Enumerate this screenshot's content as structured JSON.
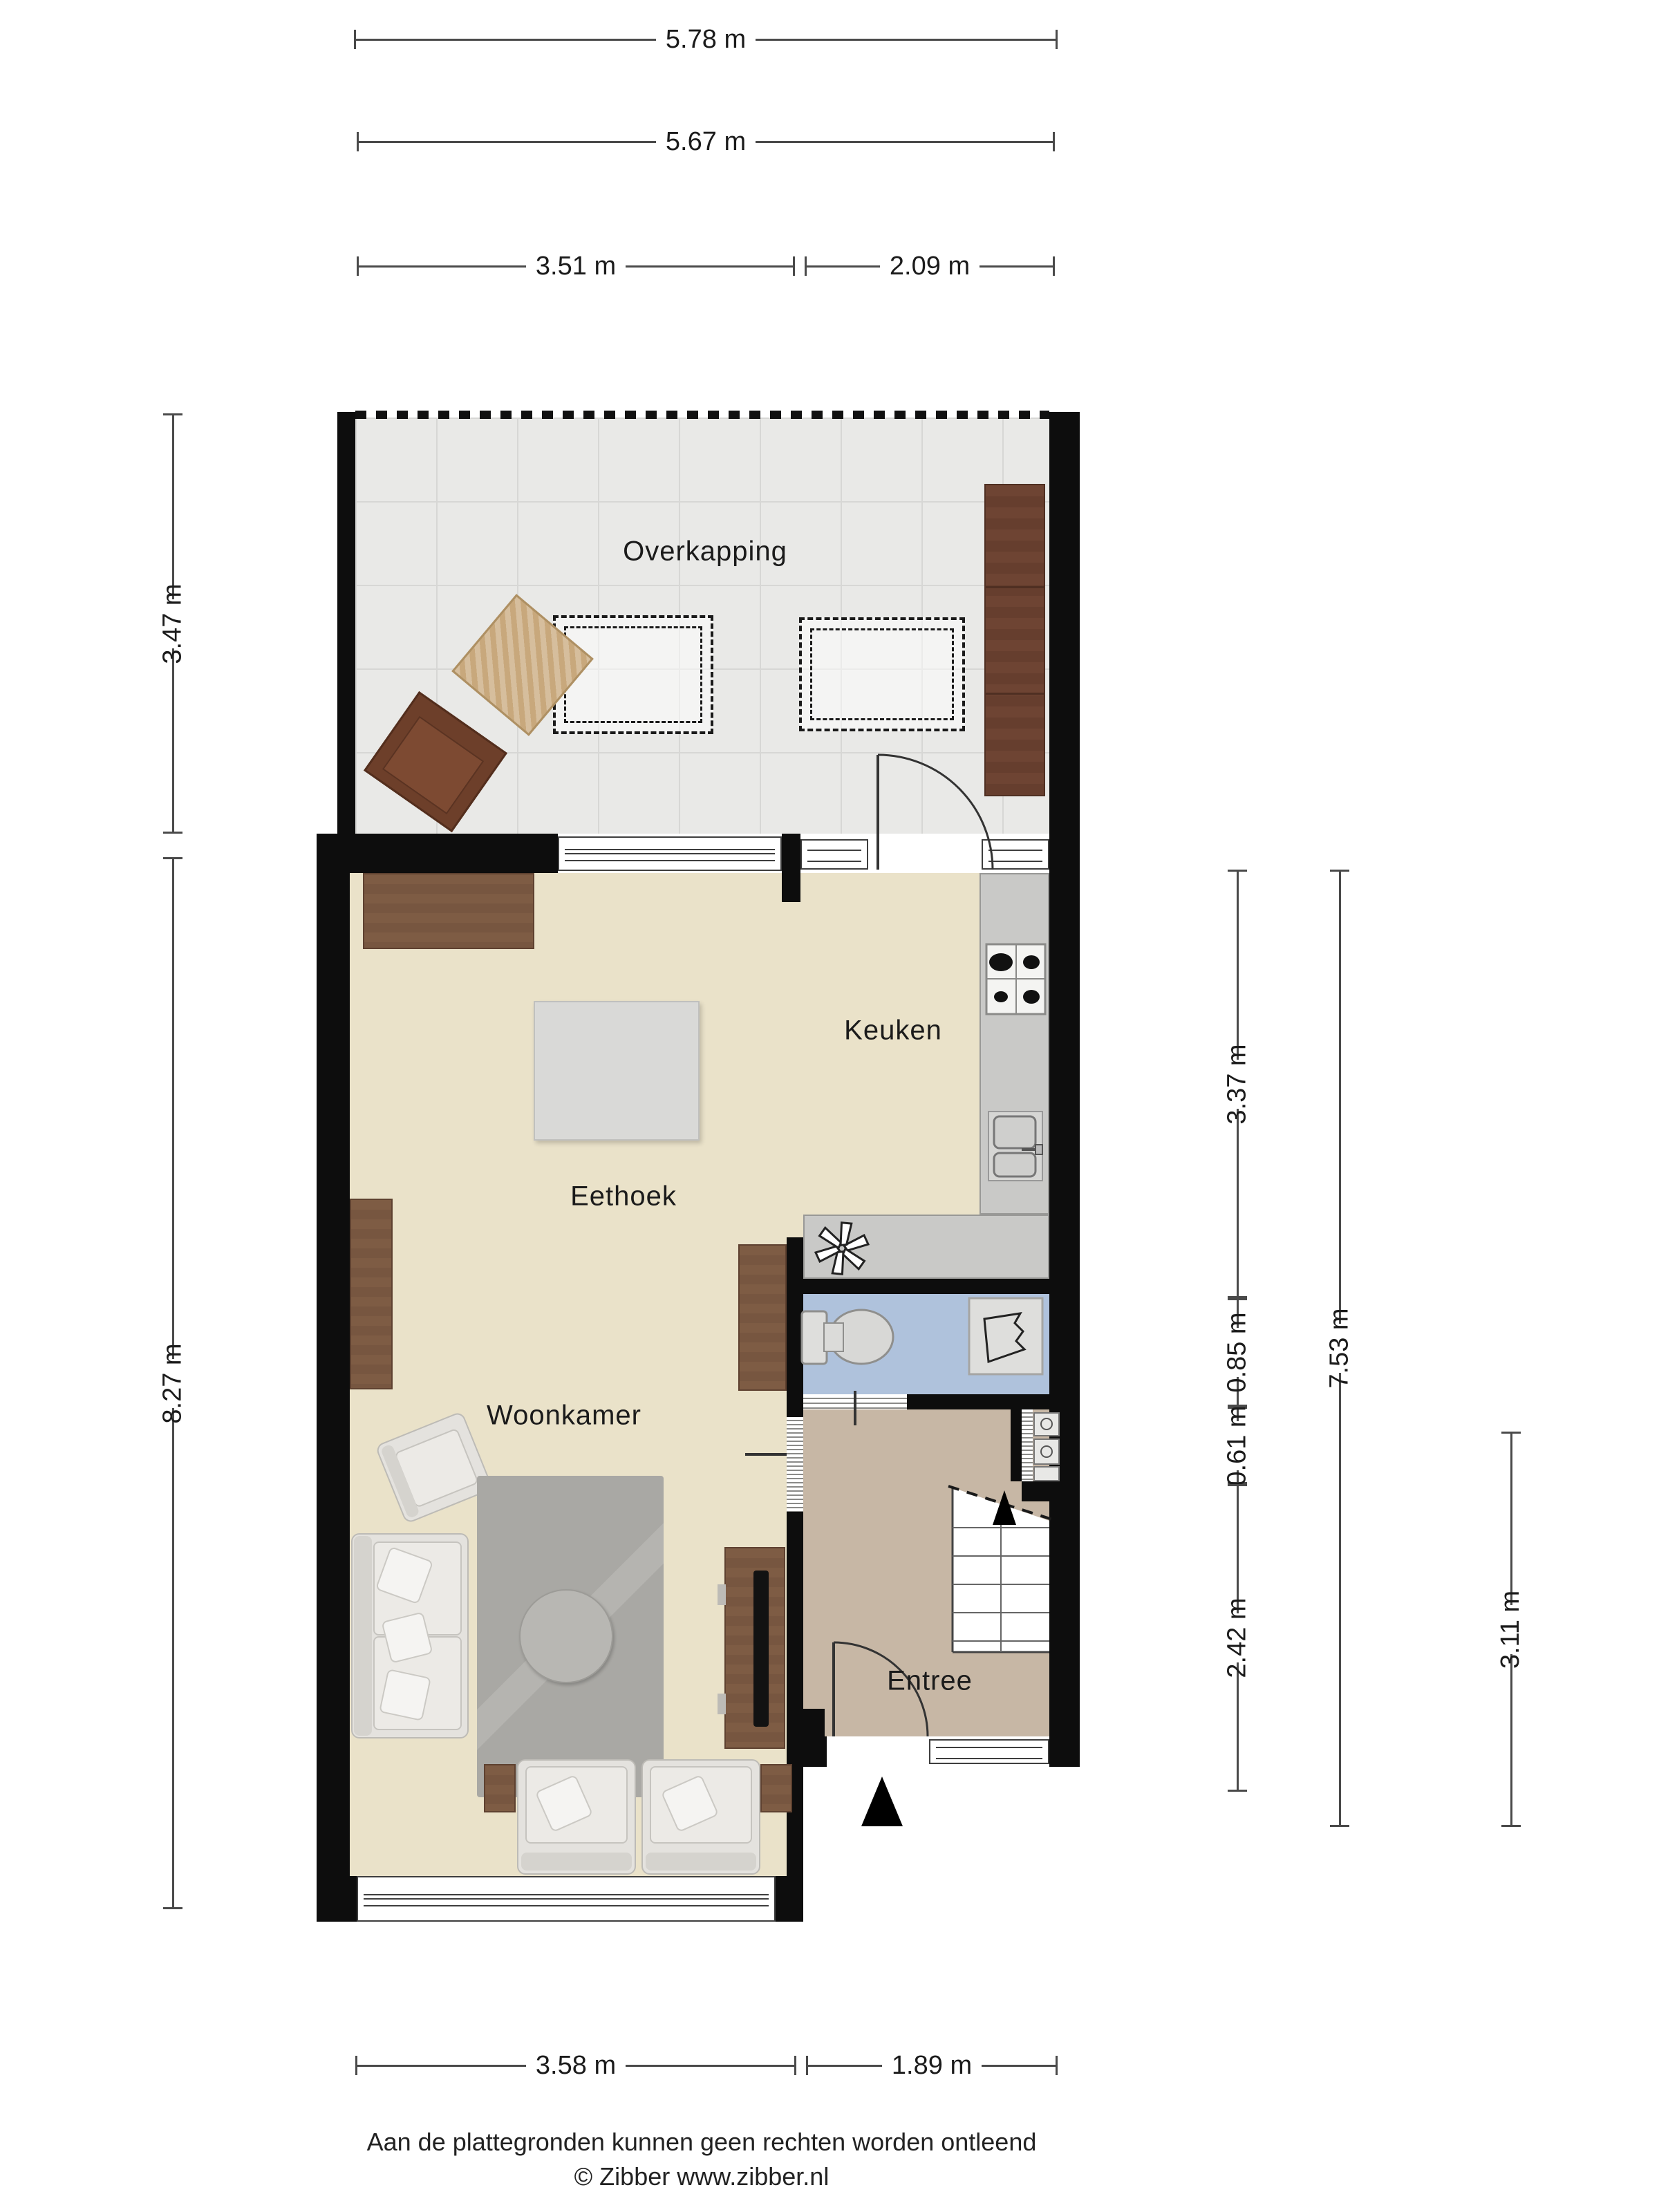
{
  "title": "Plattegrond begane grond",
  "rooms": {
    "overkapping": "Overkapping",
    "keuken": "Keuken",
    "eethoek": "Eethoek",
    "woonkamer": "Woonkamer",
    "entree": "Entree"
  },
  "dimensions": {
    "top": [
      {
        "label": "5.78 m"
      },
      {
        "label": "5.67 m"
      },
      {
        "label": "3.51 m"
      },
      {
        "label": "2.09 m"
      }
    ],
    "left": [
      {
        "label": "3.47 m"
      },
      {
        "label": "8.27 m"
      }
    ],
    "right": [
      {
        "label": "3.37 m"
      },
      {
        "label": "0.85 m"
      },
      {
        "label": "0.61 m"
      },
      {
        "label": "2.42 m"
      },
      {
        "label": "7.53 m"
      },
      {
        "label": "3.11 m"
      }
    ],
    "bottom": [
      {
        "label": "3.58 m"
      },
      {
        "label": "1.89 m"
      }
    ]
  },
  "footer": {
    "disclaimer": "Aan de plattegronden kunnen geen rechten worden ontleend",
    "credit": "© Zibber www.zibber.nl"
  },
  "icons": {
    "fan": "ventilation-fan-icon",
    "toilet": "toilet-icon",
    "fontein": "hand-basin-icon",
    "stove": "stove-icon",
    "sink": "sink-icon",
    "stairs": "staircase-icon",
    "entrance_arrow": "entrance-arrow-icon"
  },
  "colors": {
    "wall": "#0d0d0d",
    "floor_main": "#EAE2C9",
    "floor_entree": "#C7B7A5",
    "floor_toilet": "#AFC2DC",
    "floor_overkapping": "#E9E9E7",
    "counter": "#C9C9C7",
    "wood": "#7E5C44"
  }
}
